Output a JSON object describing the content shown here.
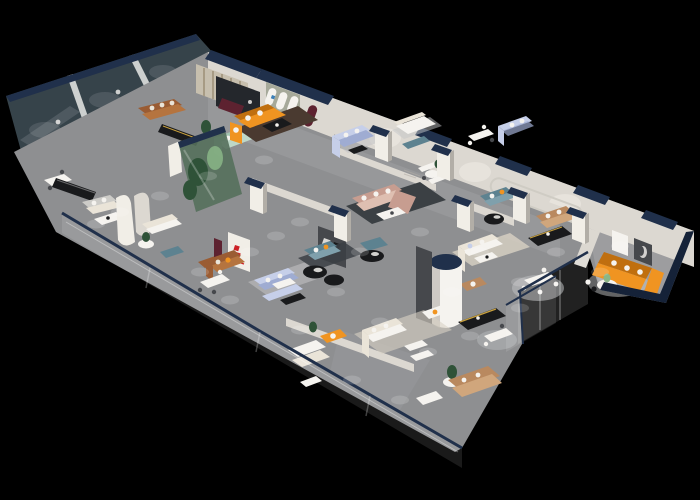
{
  "meta": {
    "title": "3D isometric cutaway render of a furniture showroom floor",
    "view": "axonometric top-down, floor plate on black background"
  },
  "scene": {
    "background": "#000000",
    "brand_marks": [
      {
        "name": "red-brand-logo",
        "color": "#CC2127",
        "location": "white curved partition, center-left"
      },
      {
        "name": "blue-brand-logo",
        "color": "#3A7FB8",
        "location": "arched display wall, top-center"
      }
    ],
    "objects": [
      {
        "name": "nw-glass-offices",
        "color_key": "glassDark"
      },
      {
        "name": "ne-wall-band",
        "color_key": "wall"
      },
      {
        "name": "navy-wall-caps",
        "color_key": "navy"
      },
      {
        "name": "arch-display-wall",
        "color_key": "sage"
      },
      {
        "name": "orange-sofa-room-top",
        "color_key": "orange"
      },
      {
        "name": "orange-sofa-annex-right",
        "color_key": "orange"
      },
      {
        "name": "orange-armchair-bottom",
        "color_key": "orange"
      },
      {
        "name": "green-aquarium-case",
        "color_key": "glassGreen"
      },
      {
        "name": "sage-sofa",
        "color_key": "sageSofa"
      },
      {
        "name": "cognac-leather-sofas",
        "color_key": "cognac"
      },
      {
        "name": "blush-sectional",
        "color_key": "blush"
      },
      {
        "name": "periwinkle-sofas",
        "color_key": "periwinkle"
      },
      {
        "name": "teal-sofas",
        "color_key": "teal"
      },
      {
        "name": "tan-sofas",
        "color_key": "tan"
      },
      {
        "name": "cream-white-sofas",
        "color_key": "cream"
      },
      {
        "name": "black-media-consoles",
        "color_key": "black"
      },
      {
        "name": "round-column",
        "color_key": "white"
      },
      {
        "name": "charcoal-feature-walls",
        "color_key": "charcoal"
      },
      {
        "name": "maroon-accent-panels",
        "color_key": "maroon"
      },
      {
        "name": "glass-balustrade-southwest",
        "color_key": "glow"
      },
      {
        "name": "glass-partitions-southeast",
        "color_key": "glow"
      },
      {
        "name": "white-dining-sets",
        "color_key": "white"
      },
      {
        "name": "area-rugs",
        "color_key": "rugDark"
      },
      {
        "name": "plants",
        "color_key": "plantDark"
      },
      {
        "name": "downlight-pools",
        "color_key": "glow"
      }
    ]
  },
  "palette": {
    "bg": "#000000",
    "floor": "#8E8F91",
    "floorLight": "#A9AAAC",
    "floorDark": "#6E6F71",
    "wall": "#DCD8D1",
    "wallBright": "#F1EEE7",
    "wallShadow": "#B2AEA7",
    "lightLine": "#CFCCC4",
    "navy": "#20304B",
    "navyDeep": "#152238",
    "glassDark": "#36434A",
    "glassMullion": "#E8E9E6",
    "glassHint": "#566066",
    "glassGreen": "#55705C",
    "plantDark": "#2F5238",
    "plantLight": "#8AB687",
    "orange": "#F09421",
    "orangeDark": "#C06F0F",
    "teal": "#5D8290",
    "tealLight": "#7FA0AC",
    "blush": "#C79D90",
    "blushLight": "#DEBFB1",
    "periwinkle": "#C6CFE9",
    "periwinkleDark": "#9FACD2",
    "sage": "#A6A99A",
    "sageSofa": "#A3C4B1",
    "sageSeat": "#BED8C8",
    "cognac": "#9A5C33",
    "cognacSeat": "#B5743F",
    "tan": "#B9895F",
    "tanLight": "#D0A67C",
    "cream": "#EAE4D8",
    "white": "#F5F3EF",
    "black": "#191A1C",
    "charcoal": "#46484C",
    "darkRoom": "#24272C",
    "maroon": "#5D2230",
    "red": "#CC2127",
    "blue": "#3A7FB8",
    "gold": "#C9A13E",
    "rugDark": "#3B4044",
    "rugBrown": "#4A3A30",
    "rugCream": "#D9D2C4",
    "rugPale": "#C4C5C7",
    "stripe": "#C7BFAE",
    "stripeDark": "#A79B84",
    "lightGray": "#CDCCC8",
    "glow": "#FFFFFF"
  }
}
